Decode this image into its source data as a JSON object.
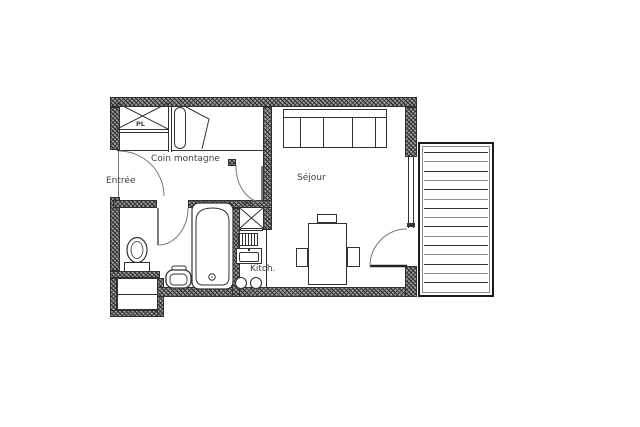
{
  "floorplan": {
    "labels": {
      "entree": "Entrée",
      "coin_montagne": "Coin montagne",
      "sejour": "Séjour",
      "kitchen": "Kitch.",
      "closet_hall": "PL",
      "closet_kitchen": "PL"
    },
    "colors": {
      "wall": "#4a4a4a",
      "line": "#333333",
      "text": "#3f3f3f",
      "background": "#ffffff"
    }
  }
}
